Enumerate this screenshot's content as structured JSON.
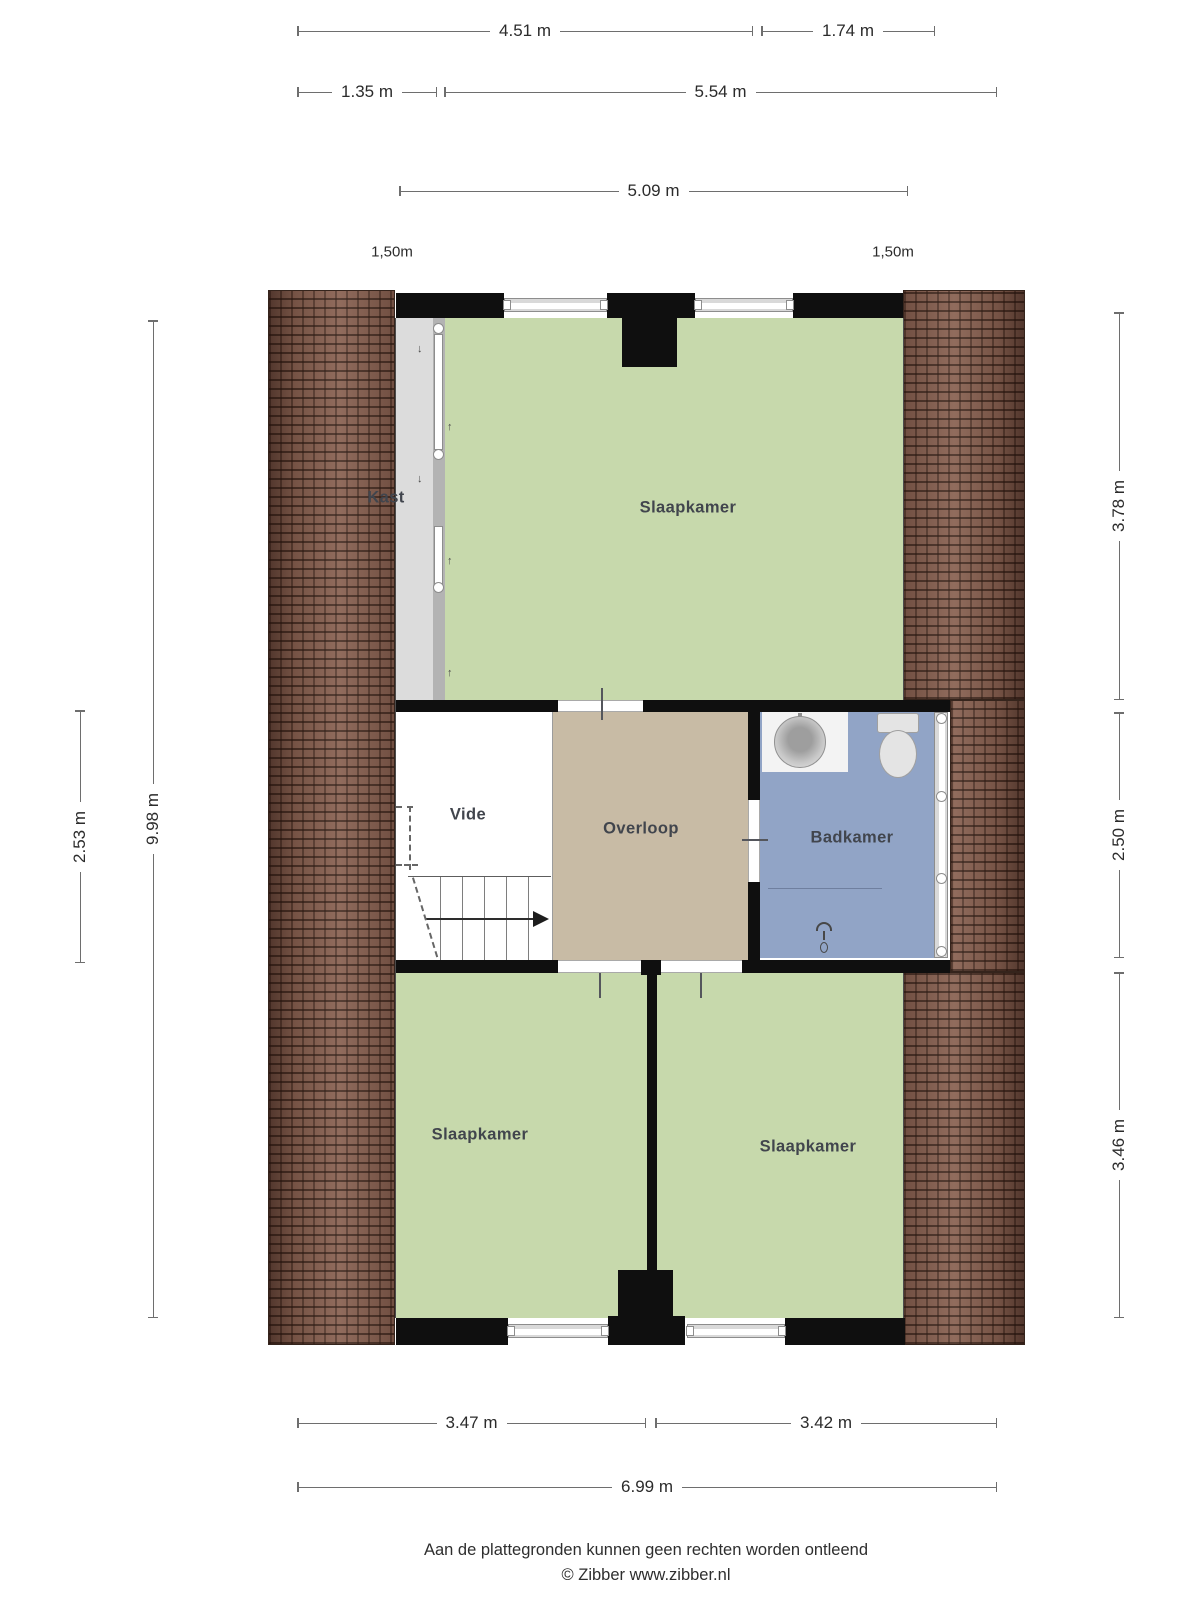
{
  "plan": {
    "rooms": {
      "kast": "Kast",
      "slaapkamer_top": "Slaapkamer",
      "vide": "Vide",
      "overloop": "Overloop",
      "badkamer": "Badkamer",
      "slaapkamer_left": "Slaapkamer",
      "slaapkamer_right": "Slaapkamer"
    },
    "headroom_left": "1,50m",
    "headroom_right": "1,50m"
  },
  "dimensions": {
    "top_row1_left": "4.51 m",
    "top_row1_right": "1.74 m",
    "top_row2_left": "1.35 m",
    "top_row2_right": "5.54 m",
    "top_row3": "5.09 m",
    "left_outer": "2.53 m",
    "left_inner": "9.98 m",
    "right_top": "3.78 m",
    "right_middle": "2.50 m",
    "right_bottom": "3.46 m",
    "bottom_left": "3.47 m",
    "bottom_right": "3.42 m",
    "bottom_total": "6.99 m"
  },
  "footer": {
    "disclaimer": "Aan de plattegronden kunnen geen rechten worden ontleend",
    "credit": "© Zibber www.zibber.nl"
  },
  "colors": {
    "wall": "#0f0f0f",
    "room-green": "#c7d9ac",
    "room-tan": "#c8bba5",
    "room-blue": "#91a4c6",
    "room-gray": "#dcdcdc",
    "brick": "#8a6353",
    "label": "#41454d"
  }
}
